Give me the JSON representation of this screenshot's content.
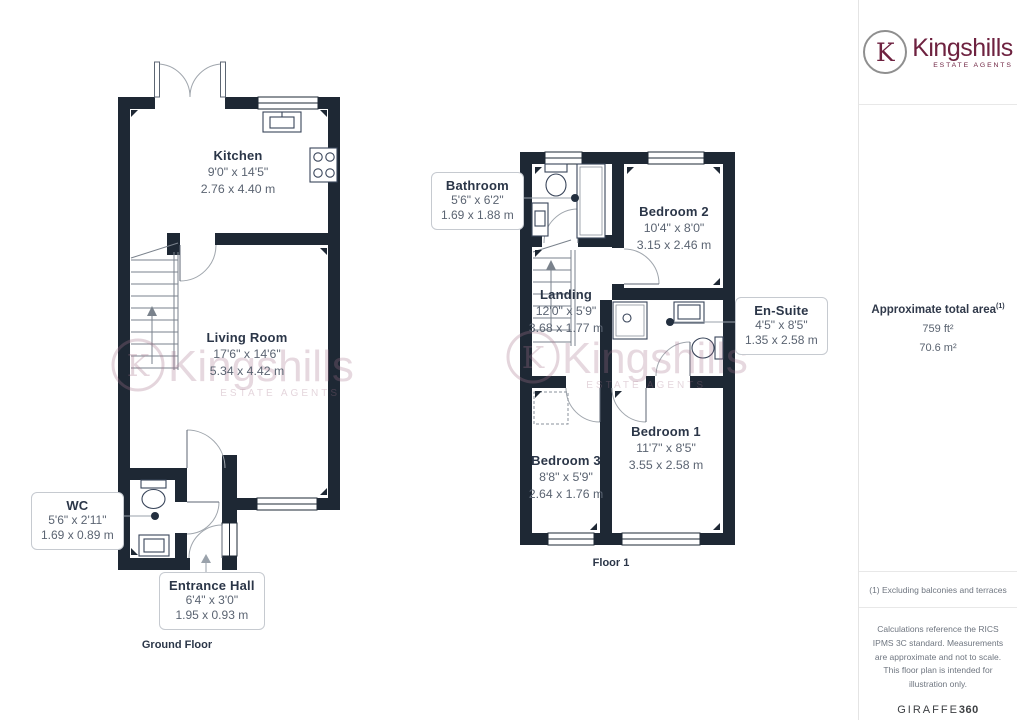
{
  "branding": {
    "monogram": "K",
    "name": "Kingshills",
    "tagline": "ESTATE AGENTS",
    "brand_color": "#6e2240"
  },
  "watermark": {
    "monogram": "K",
    "name": "Kingshills",
    "tagline": "ESTATE AGENTS"
  },
  "sidebar": {
    "area_title": "Approximate total area",
    "area_marker": "(1)",
    "area_imperial": "759 ft²",
    "area_metric": "70.6 m²",
    "footnote": "(1) Excluding balconies and terraces",
    "disclaimer": "Calculations reference the RICS IPMS 3C standard. Measurements are approximate and not to scale. This floor plan is intended for illustration only.",
    "provider": "GIRAFFE",
    "provider_suffix": "360"
  },
  "ground_floor": {
    "title": "Ground Floor",
    "rooms": [
      {
        "name": "Kitchen",
        "imperial": "9'0\" x 14'5\"",
        "metric": "2.76 x 4.40 m"
      },
      {
        "name": "Living Room",
        "imperial": "17'6\" x 14'6\"",
        "metric": "5.34 x 4.42 m"
      }
    ],
    "callouts": [
      {
        "name": "WC",
        "imperial": "5'6\" x 2'11\"",
        "metric": "1.69 x 0.89 m"
      },
      {
        "name": "Entrance Hall",
        "imperial": "6'4\" x 3'0\"",
        "metric": "1.95 x 0.93 m"
      }
    ]
  },
  "first_floor": {
    "title": "Floor 1",
    "rooms": [
      {
        "name": "Bedroom 2",
        "imperial": "10'4\" x 8'0\"",
        "metric": "3.15 x 2.46 m"
      },
      {
        "name": "Landing",
        "imperial": "12'0\" x 5'9\"",
        "metric": "3.68 x 1.77 m"
      },
      {
        "name": "Bedroom 3",
        "imperial": "8'8\" x 5'9\"",
        "metric": "2.64 x 1.76 m"
      },
      {
        "name": "Bedroom 1",
        "imperial": "11'7\" x 8'5\"",
        "metric": "3.55 x 2.58 m"
      }
    ],
    "callouts": [
      {
        "name": "Bathroom",
        "imperial": "5'6\" x 6'2\"",
        "metric": "1.69 x 1.88 m"
      },
      {
        "name": "En-Suite",
        "imperial": "4'5\" x 8'5\"",
        "metric": "1.35 x 2.58 m"
      }
    ]
  }
}
